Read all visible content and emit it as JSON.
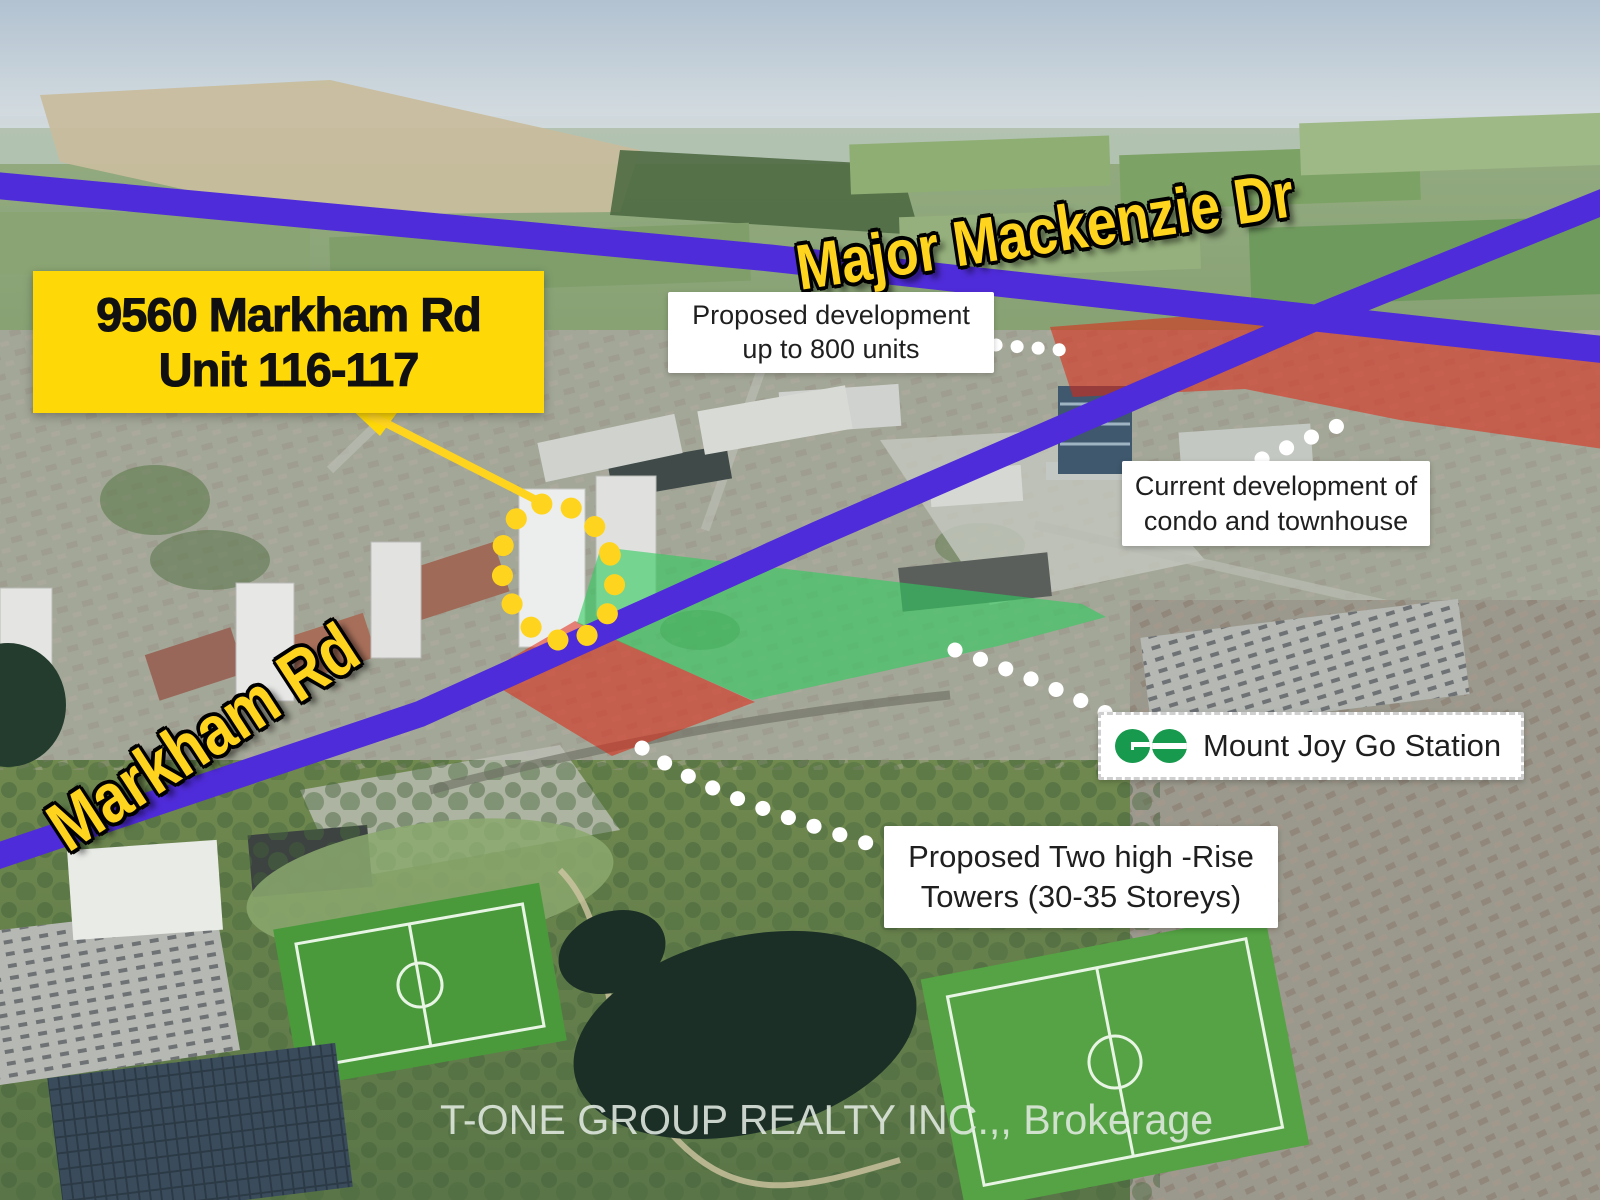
{
  "site_banner": {
    "line1": "9560 Markham Rd",
    "line2": "Unit 116-117"
  },
  "road_labels": {
    "major_mackenzie": "Major Mackenzie Dr",
    "markham": "Markham Rd"
  },
  "callouts": {
    "proposed_development": {
      "line1": "Proposed development",
      "line2": "up to 800 units"
    },
    "current_development": {
      "line1": "Current development of",
      "line2": "condo and townhouse"
    },
    "go_station": {
      "label": "Mount Joy Go Station",
      "icon": "go-transit-logo"
    },
    "proposed_towers": {
      "line1": "Proposed Two high -Rise",
      "line2": "Towers (30-35 Storeys)"
    }
  },
  "watermark": "T-ONE GROUP REALTY INC.,, Brokerage",
  "map_overlays": {
    "red_highlight_north": "proposed-development-lands",
    "red_highlight_site": "commercial-plaza-site",
    "green_highlight": "mount-joy-go-parking-lot",
    "subject_marker": "yellow-dotted-circle"
  },
  "colors": {
    "banner_yellow": "#ffd808",
    "label_yellow": "#ffd41e",
    "road_purple": "#4f2cd9",
    "overlay_red": "#e02412",
    "overlay_green": "#2ecc5e",
    "go_green": "#179a4e",
    "callout_bg": "#ffffff",
    "callout_text": "#1f1f1f",
    "watermark_gray": "#e2eae2"
  }
}
